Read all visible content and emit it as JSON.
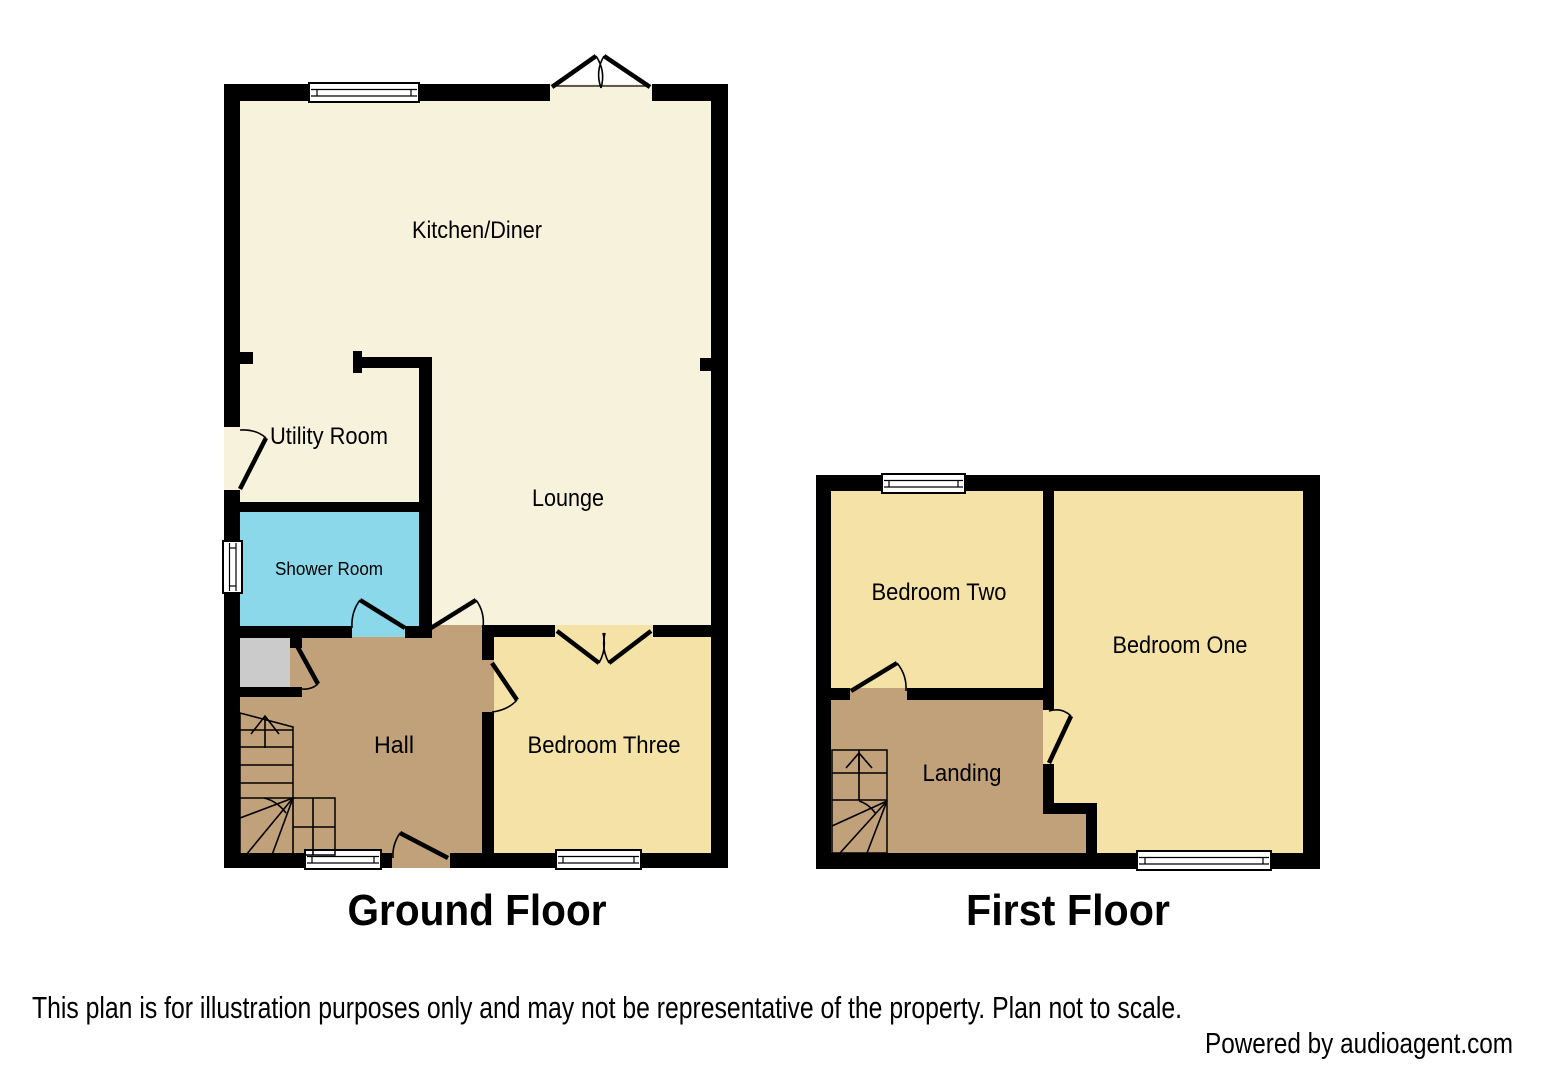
{
  "ground_floor": {
    "title": "Ground Floor",
    "rooms": {
      "kitchen_diner": "Kitchen/Diner",
      "utility_room": "Utility Room",
      "shower_room": "Shower Room",
      "lounge": "Lounge",
      "hall": "Hall",
      "bedroom_three": "Bedroom Three"
    }
  },
  "first_floor": {
    "title": "First Floor",
    "rooms": {
      "bedroom_two": "Bedroom Two",
      "bedroom_one": "Bedroom One",
      "landing": "Landing"
    }
  },
  "footer": {
    "disclaimer": "This plan is for illustration purposes only and may not be representative of the property. Plan not to scale.",
    "credit": "Powered by audioagent.com"
  },
  "colors": {
    "wall": "#000000",
    "floor_cream": "#F7F2DC",
    "floor_yellow": "#F5E2A6",
    "floor_tan": "#C1A179",
    "floor_blue": "#8AD8E9",
    "stairs_gray": "#C6C6C6",
    "closet_gray": "#CBCBCB",
    "background": "#FFFFFF"
  }
}
